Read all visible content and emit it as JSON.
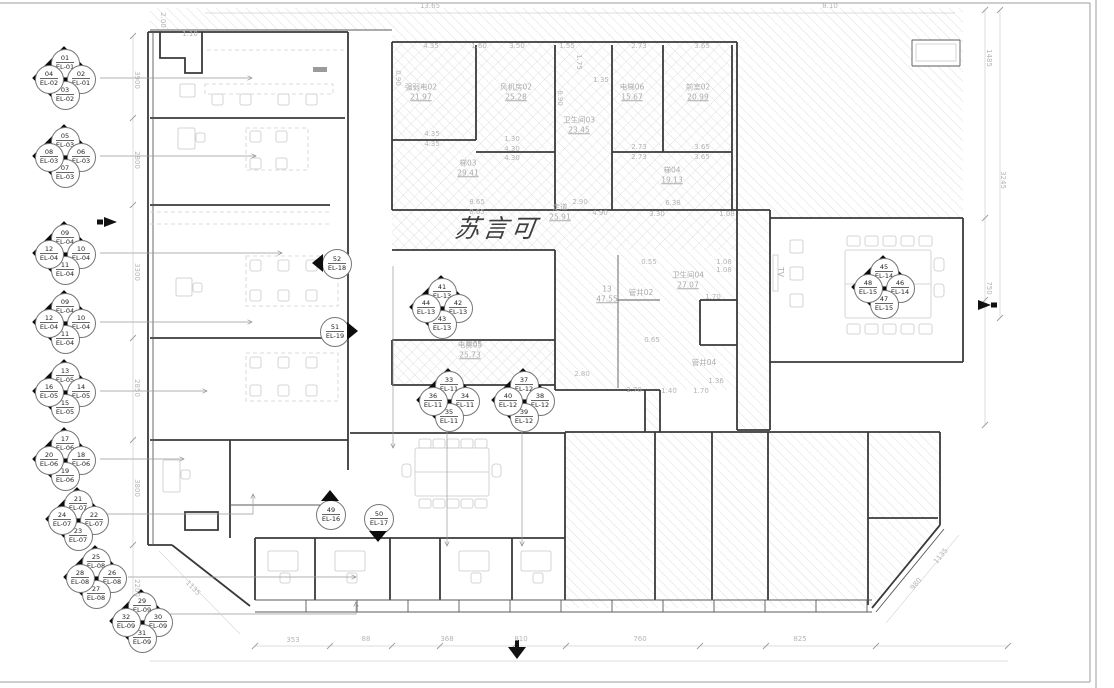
{
  "plan": {
    "watermark": {
      "text": "苏言可",
      "x": 497,
      "y": 227
    },
    "colors": {
      "wall": "#3a3a3a",
      "hatch": "#dedede",
      "annotation": "#ababab",
      "marker_fill": "#0d0d0d"
    },
    "quad_markers": [
      {
        "id": "EL-01-02",
        "x": 64,
        "y": 78,
        "t": {
          "n": "01",
          "l": "EL-01"
        },
        "r": {
          "n": "02",
          "l": "EL-01"
        },
        "b": {
          "n": "03",
          "l": "EL-02"
        },
        "l": {
          "n": "04",
          "l": "EL-02"
        }
      },
      {
        "id": "EL-03",
        "x": 64,
        "y": 156,
        "t": {
          "n": "05",
          "l": "EL-03"
        },
        "r": {
          "n": "06",
          "l": "EL-03"
        },
        "b": {
          "n": "07",
          "l": "EL-03"
        },
        "l": {
          "n": "08",
          "l": "EL-03"
        }
      },
      {
        "id": "EL-04-a",
        "x": 64,
        "y": 253,
        "t": {
          "n": "09",
          "l": "EL-04"
        },
        "r": {
          "n": "10",
          "l": "EL-04"
        },
        "b": {
          "n": "11",
          "l": "EL-04"
        },
        "l": {
          "n": "12",
          "l": "EL-04"
        }
      },
      {
        "id": "EL-04-b",
        "x": 64,
        "y": 322,
        "t": {
          "n": "09",
          "l": "EL-04"
        },
        "r": {
          "n": "10",
          "l": "EL-04"
        },
        "b": {
          "n": "11",
          "l": "EL-04"
        },
        "l": {
          "n": "12",
          "l": "EL-04"
        }
      },
      {
        "id": "EL-05",
        "x": 64,
        "y": 391,
        "t": {
          "n": "13",
          "l": "EL-05"
        },
        "r": {
          "n": "14",
          "l": "EL-05"
        },
        "b": {
          "n": "15",
          "l": "EL-05"
        },
        "l": {
          "n": "16",
          "l": "EL-05"
        }
      },
      {
        "id": "EL-06",
        "x": 64,
        "y": 459,
        "t": {
          "n": "17",
          "l": "EL-06"
        },
        "r": {
          "n": "18",
          "l": "EL-06"
        },
        "b": {
          "n": "19",
          "l": "EL-06"
        },
        "l": {
          "n": "20",
          "l": "EL-06"
        }
      },
      {
        "id": "EL-07",
        "x": 77,
        "y": 519,
        "t": {
          "n": "21",
          "l": "EL-07"
        },
        "r": {
          "n": "22",
          "l": "EL-07"
        },
        "b": {
          "n": "23",
          "l": "EL-07"
        },
        "l": {
          "n": "24",
          "l": "EL-07"
        }
      },
      {
        "id": "EL-08",
        "x": 95,
        "y": 577,
        "t": {
          "n": "25",
          "l": "EL-08"
        },
        "r": {
          "n": "26",
          "l": "EL-08"
        },
        "b": {
          "n": "27",
          "l": "EL-08"
        },
        "l": {
          "n": "28",
          "l": "EL-08"
        }
      },
      {
        "id": "EL-09",
        "x": 141,
        "y": 621,
        "t": {
          "n": "29",
          "l": "EL-09"
        },
        "r": {
          "n": "30",
          "l": "EL-09"
        },
        "b": {
          "n": "31",
          "l": "EL-09"
        },
        "l": {
          "n": "32",
          "l": "EL-09"
        }
      },
      {
        "id": "EL-13",
        "x": 441,
        "y": 307,
        "t": {
          "n": "41",
          "l": "EL-13"
        },
        "r": {
          "n": "42",
          "l": "EL-13"
        },
        "b": {
          "n": "43",
          "l": "EL-13"
        },
        "l": {
          "n": "44",
          "l": "EL-13"
        }
      },
      {
        "id": "EL-11",
        "x": 448,
        "y": 400,
        "t": {
          "n": "33",
          "l": "EL-11"
        },
        "r": {
          "n": "34",
          "l": "EL-11"
        },
        "b": {
          "n": "35",
          "l": "EL-11"
        },
        "l": {
          "n": "36",
          "l": "EL-11"
        }
      },
      {
        "id": "EL-12",
        "x": 523,
        "y": 400,
        "t": {
          "n": "37",
          "l": "EL-12"
        },
        "r": {
          "n": "38",
          "l": "EL-12"
        },
        "b": {
          "n": "39",
          "l": "EL-12"
        },
        "l": {
          "n": "40",
          "l": "EL-12"
        }
      },
      {
        "id": "EL-14-15",
        "x": 883,
        "y": 287,
        "t": {
          "n": "45",
          "l": "EL-14"
        },
        "r": {
          "n": "46",
          "l": "EL-14"
        },
        "b": {
          "n": "47",
          "l": "EL-15"
        },
        "l": {
          "n": "48",
          "l": "EL-15"
        }
      }
    ],
    "single_markers": [
      {
        "id": "EL-18",
        "x": 336,
        "y": 263,
        "dir": "left",
        "n": "52",
        "l": "EL-18"
      },
      {
        "id": "EL-19",
        "x": 334,
        "y": 331,
        "dir": "right",
        "n": "51",
        "l": "EL-19"
      },
      {
        "id": "EL-16",
        "x": 330,
        "y": 514,
        "dir": "up",
        "n": "49",
        "l": "EL-16"
      },
      {
        "id": "EL-17",
        "x": 378,
        "y": 518,
        "dir": "down",
        "n": "50",
        "l": "EL-17"
      }
    ],
    "room_labels": [
      {
        "name": "强弱电02",
        "area": "21.97",
        "x": 421,
        "y": 92
      },
      {
        "name": "风机房02",
        "area": "25.28",
        "x": 516,
        "y": 92
      },
      {
        "name": "卫生间03",
        "area": "23.45",
        "x": 579,
        "y": 125
      },
      {
        "name": "梯03",
        "area": "29.41",
        "x": 468,
        "y": 168
      },
      {
        "name": "电梯06",
        "area": "15.67",
        "x": 632,
        "y": 92
      },
      {
        "name": "前室02",
        "area": "20.99",
        "x": 698,
        "y": 92
      },
      {
        "name": "梯04",
        "area": "19.13",
        "x": 672,
        "y": 175
      },
      {
        "name": "走道",
        "area": "25.91",
        "x": 560,
        "y": 212
      },
      {
        "name": "13",
        "area": "47.55",
        "x": 607,
        "y": 294
      },
      {
        "name": "电梯05",
        "area": "25.73",
        "x": 470,
        "y": 350
      },
      {
        "name": "卫生间04",
        "area": "27.07",
        "x": 688,
        "y": 280
      },
      {
        "name": "管井02",
        "area": "",
        "x": 641,
        "y": 293
      },
      {
        "name": "管井04",
        "area": "",
        "x": 704,
        "y": 363
      },
      {
        "name": "TV",
        "area": "",
        "x": 780,
        "y": 272,
        "rot": 90
      }
    ],
    "dim_labels": [
      {
        "v": "13.65",
        "x": 430,
        "y": 6,
        "r": 0
      },
      {
        "v": "8.10",
        "x": 830,
        "y": 6,
        "r": 0
      },
      {
        "v": "1.10",
        "x": 190,
        "y": 34,
        "r": 0
      },
      {
        "v": "2.00",
        "x": 163,
        "y": 20,
        "r": 90
      },
      {
        "v": "4.35",
        "x": 431,
        "y": 46,
        "r": 0
      },
      {
        "v": "1.60",
        "x": 479,
        "y": 46,
        "r": 0
      },
      {
        "v": "3.50",
        "x": 517,
        "y": 46,
        "r": 0
      },
      {
        "v": "1.55",
        "x": 567,
        "y": 46,
        "r": 0
      },
      {
        "v": "2.73",
        "x": 639,
        "y": 46,
        "r": 0
      },
      {
        "v": "3.65",
        "x": 702,
        "y": 46,
        "r": 0
      },
      {
        "v": "1.75",
        "x": 579,
        "y": 62,
        "r": 90
      },
      {
        "v": "1.35",
        "x": 601,
        "y": 80,
        "r": 0
      },
      {
        "v": "0.90",
        "x": 398,
        "y": 78,
        "r": 90
      },
      {
        "v": "6.90",
        "x": 560,
        "y": 98,
        "r": 90
      },
      {
        "v": "4.35",
        "x": 432,
        "y": 134,
        "r": 0
      },
      {
        "v": "4.35",
        "x": 432,
        "y": 144,
        "r": 0
      },
      {
        "v": "1.30",
        "x": 512,
        "y": 139,
        "r": 0
      },
      {
        "v": "4.30",
        "x": 512,
        "y": 149,
        "r": 0
      },
      {
        "v": "4.30",
        "x": 512,
        "y": 158,
        "r": 0
      },
      {
        "v": "2.73",
        "x": 639,
        "y": 147,
        "r": 0
      },
      {
        "v": "3.65",
        "x": 702,
        "y": 147,
        "r": 0
      },
      {
        "v": "2.73",
        "x": 639,
        "y": 157,
        "r": 0
      },
      {
        "v": "3.65",
        "x": 702,
        "y": 157,
        "r": 0
      },
      {
        "v": "8.65",
        "x": 477,
        "y": 202,
        "r": 0
      },
      {
        "v": "8.65",
        "x": 477,
        "y": 212,
        "r": 0
      },
      {
        "v": "2.90",
        "x": 580,
        "y": 202,
        "r": 0
      },
      {
        "v": "4.90",
        "x": 600,
        "y": 213,
        "r": 0
      },
      {
        "v": "6.38",
        "x": 673,
        "y": 203,
        "r": 0
      },
      {
        "v": "3.30",
        "x": 657,
        "y": 214,
        "r": 0
      },
      {
        "v": "1.08",
        "x": 727,
        "y": 214,
        "r": 0
      },
      {
        "v": "0.55",
        "x": 649,
        "y": 262,
        "r": 0
      },
      {
        "v": "1.08",
        "x": 724,
        "y": 262,
        "r": 0
      },
      {
        "v": "1.08",
        "x": 724,
        "y": 270,
        "r": 0
      },
      {
        "v": "1.70",
        "x": 713,
        "y": 297,
        "r": 0
      },
      {
        "v": "0.65",
        "x": 652,
        "y": 340,
        "r": 0
      },
      {
        "v": "8.65",
        "x": 474,
        "y": 344,
        "r": 0
      },
      {
        "v": "2.80",
        "x": 582,
        "y": 374,
        "r": 0
      },
      {
        "v": "2.70",
        "x": 634,
        "y": 390,
        "r": 0
      },
      {
        "v": "1.40",
        "x": 669,
        "y": 391,
        "r": 0
      },
      {
        "v": "1.70",
        "x": 701,
        "y": 391,
        "r": 0
      },
      {
        "v": "1.36",
        "x": 716,
        "y": 381,
        "r": 0
      },
      {
        "v": "3900",
        "x": 137,
        "y": 80,
        "r": 90
      },
      {
        "v": "2800",
        "x": 137,
        "y": 160,
        "r": 90
      },
      {
        "v": "3300",
        "x": 137,
        "y": 272,
        "r": 90
      },
      {
        "v": "2850",
        "x": 137,
        "y": 388,
        "r": 90
      },
      {
        "v": "3800",
        "x": 137,
        "y": 488,
        "r": 90
      },
      {
        "v": "2200",
        "x": 137,
        "y": 588,
        "r": 90
      },
      {
        "v": "1485",
        "x": 989,
        "y": 58,
        "r": 90
      },
      {
        "v": "3245",
        "x": 1003,
        "y": 180,
        "r": 90
      },
      {
        "v": "750",
        "x": 989,
        "y": 288,
        "r": 90
      },
      {
        "v": "353",
        "x": 293,
        "y": 640,
        "r": 0
      },
      {
        "v": "88",
        "x": 366,
        "y": 639,
        "r": 0
      },
      {
        "v": "368",
        "x": 447,
        "y": 639,
        "r": 0
      },
      {
        "v": "810",
        "x": 521,
        "y": 639,
        "r": 0
      },
      {
        "v": "760",
        "x": 640,
        "y": 639,
        "r": 0
      },
      {
        "v": "825",
        "x": 800,
        "y": 639,
        "r": 0
      },
      {
        "v": "980",
        "x": 916,
        "y": 584,
        "r": -50
      },
      {
        "v": "1135",
        "x": 941,
        "y": 556,
        "r": -50
      },
      {
        "v": "1135",
        "x": 193,
        "y": 588,
        "r": 46
      }
    ]
  }
}
